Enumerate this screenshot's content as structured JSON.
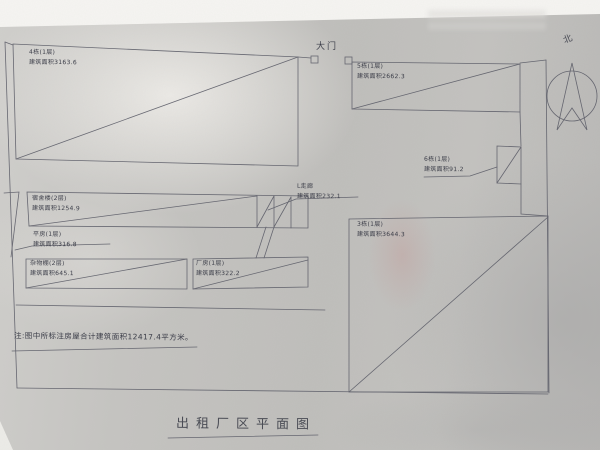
{
  "title": "出租厂区平面图",
  "note": "注:图中所标注房屋合计建筑面积12417.4平方米。",
  "gate_label": "大门",
  "compass_label": "北",
  "total_area": "12417.4",
  "area_unit": "平方米",
  "buildings": [
    {
      "name": "4栋(1层)",
      "area": "建筑面积3163.6"
    },
    {
      "name": "5栋(1层)",
      "area": "建筑面积2662.3"
    },
    {
      "name": "6栋(1层)",
      "area": "建筑面积91.2"
    },
    {
      "name": "宿舍楼(2层)",
      "area": "建筑面积1254.9"
    },
    {
      "name": "平房(1层)",
      "area": "建筑面积316.8"
    },
    {
      "name": "杂物棚(2层)",
      "area": "建筑面积645.1"
    },
    {
      "name": "厂房(1层)",
      "area": "建筑面积322.2"
    },
    {
      "name": "L走廊",
      "area": "建筑面积232.1"
    },
    {
      "name": "3栋(1层)",
      "area": "建筑面积3644.3"
    }
  ],
  "colors": {
    "line": "#5c5d68",
    "ink": "#3c3e49",
    "paper": "#c2c1be"
  }
}
